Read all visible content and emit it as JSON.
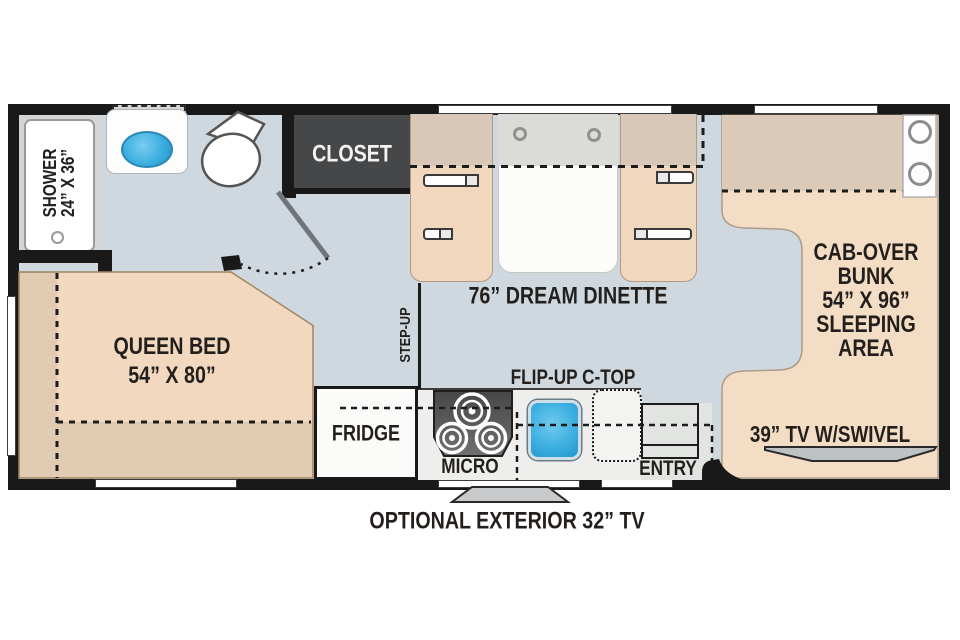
{
  "plan": {
    "type": "rv-motorhome-floor-plan",
    "rooms": [
      "bathroom",
      "bedroom",
      "dinette",
      "kitchen",
      "cab-over bunk",
      "entry"
    ]
  },
  "labels": {
    "shower": {
      "line1": "SHOWER",
      "line2": "24” X 36”"
    },
    "closet": "CLOSET",
    "dinette": "76” DREAM DINETTE",
    "queen_bed": {
      "line1": "QUEEN BED",
      "line2": "54” X 80”"
    },
    "step_up": "STEP-UP",
    "cab_over": {
      "line1": "CAB-OVER",
      "line2": "BUNK",
      "line3": "54” X 96”",
      "line4": "SLEEPING",
      "line5": "AREA"
    },
    "fridge": "FRIDGE",
    "micro": "MICRO",
    "flip_up_ctop": "FLIP-UP C-TOP",
    "entry": "ENTRY",
    "tv_swivel": "39” TV W/SWIVEL",
    "exterior_tv": "OPTIONAL EXTERIOR 32” TV"
  },
  "colors": {
    "wall": "#191919",
    "floor": "#cfd8de",
    "furniture_tan": "#f0d7be",
    "furniture_tan_dark": "#d9c7b7",
    "closet": "#454749",
    "sink_blue": "#3dafe0",
    "counter": "#eeefed",
    "tv_gray": "#bfc2c3"
  }
}
